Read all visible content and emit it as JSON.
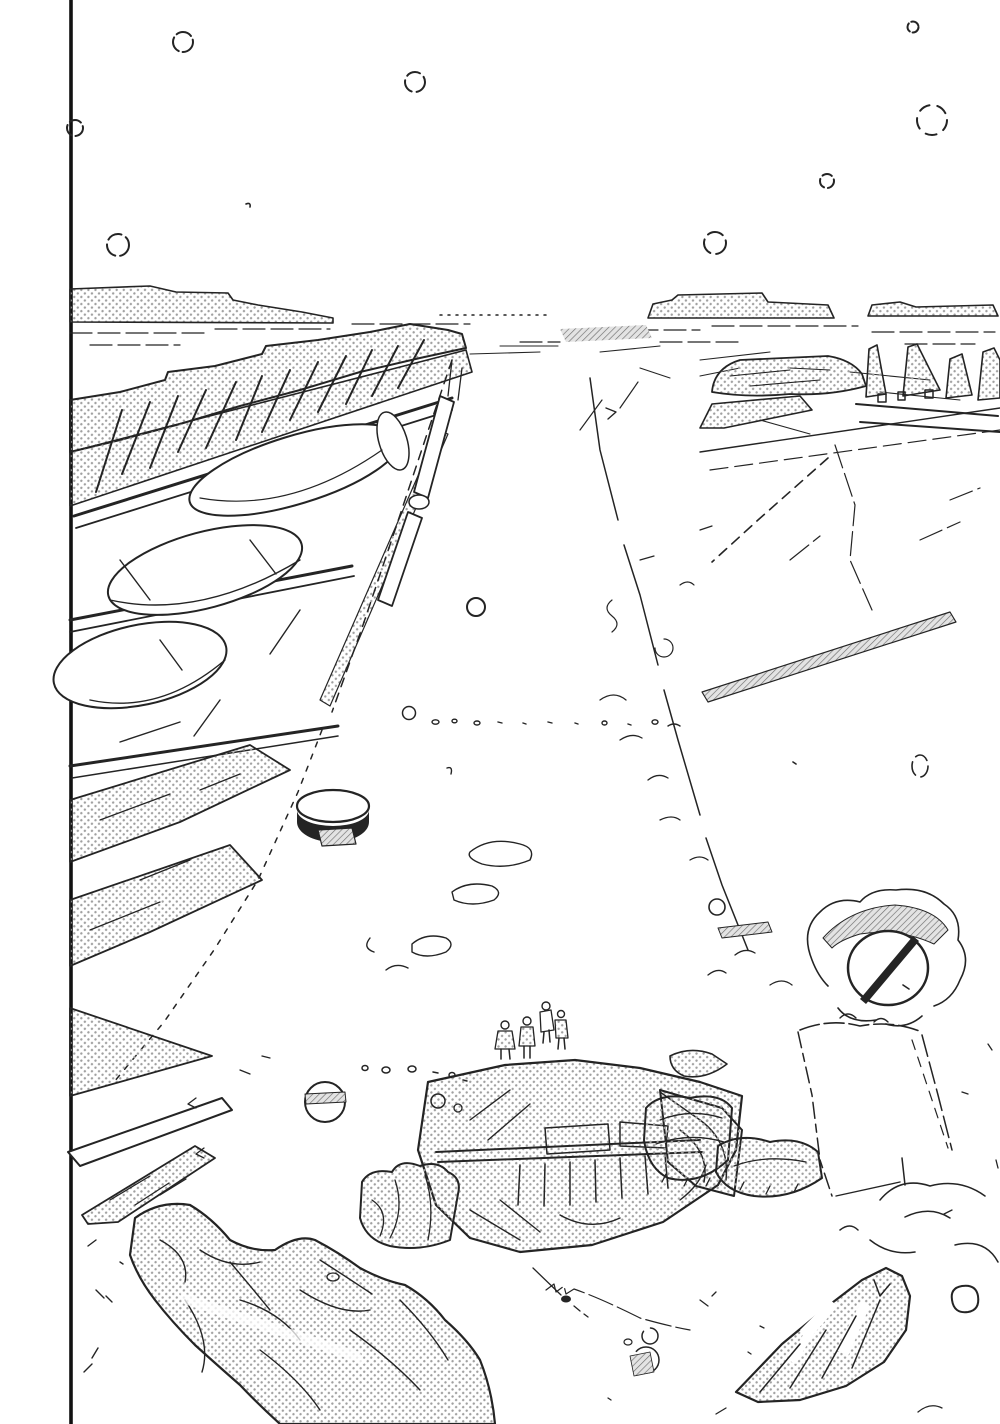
{
  "artwork": {
    "description": "black-and-white manga panel: vast wrecked corridor of debris receding to a flat horizon, ruined truss structures and tanks on the left, triangular fins on the right, four small standing figures before a large rubble pile, snow circles in the sky",
    "colors": {
      "paper": "#ffffff",
      "ink": "#242424",
      "panel_border": "#111111",
      "tone_dot": "#a0a0a0",
      "hatch_line": "#6f6f6f"
    },
    "counts": {
      "figures": 4,
      "snowflakes": 8
    }
  }
}
